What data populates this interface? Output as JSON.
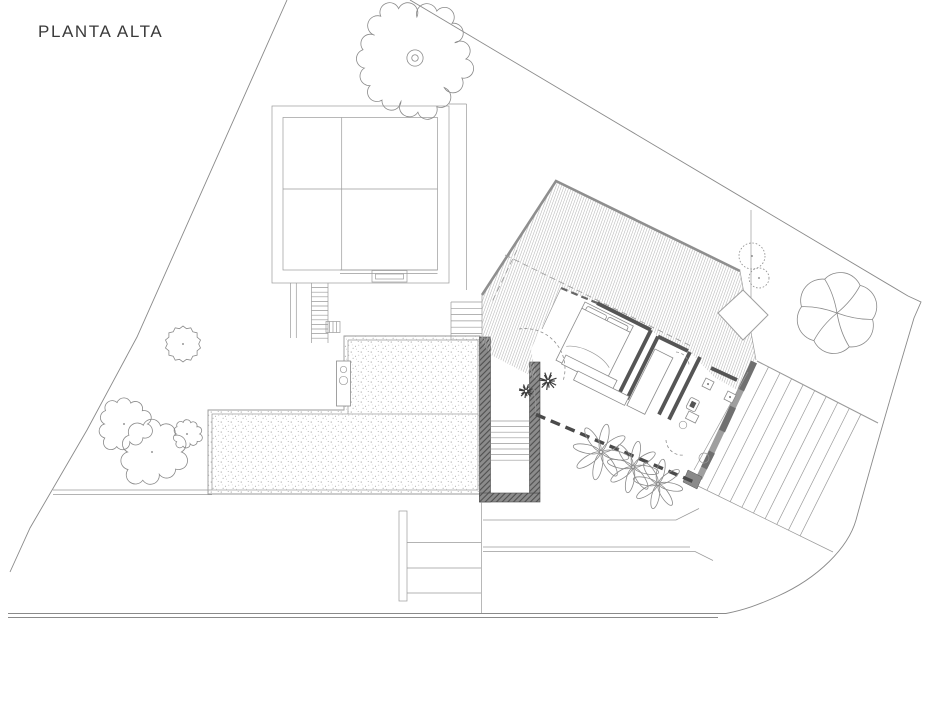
{
  "title": "PLANTA ALTA",
  "colors": {
    "background": "#ffffff",
    "line": "#9a9a9a",
    "wall": "#555555",
    "wall_fill": "#8f8f8f",
    "boundary": "#8a8a8a",
    "hatch_line": "#b5b5b5",
    "stipple_dot": "#8e8e8e",
    "title_text": "#3a3a3a"
  },
  "vegetation": {
    "scalloped_trees": [
      {
        "cx": 413,
        "cy": 59,
        "r": 54
      }
    ],
    "round_trees": [
      {
        "cx": 152,
        "cy": 452,
        "r": 30
      },
      {
        "cx": 124,
        "cy": 424,
        "r": 24
      },
      {
        "cx": 187,
        "cy": 434,
        "r": 13
      }
    ],
    "spiky_trees": [
      {
        "cx": 183,
        "cy": 344,
        "r": 18
      }
    ],
    "dotted_bushes": [
      {
        "cx": 752,
        "cy": 256,
        "r": 13
      },
      {
        "cx": 759,
        "cy": 278,
        "r": 10
      }
    ],
    "pinwheel_trees": [
      {
        "cx": 837,
        "cy": 313,
        "r": 36
      }
    ],
    "palm_plants": [
      {
        "cx": 601,
        "cy": 452,
        "r": 27
      },
      {
        "cx": 633,
        "cy": 467,
        "r": 25
      },
      {
        "cx": 658,
        "cy": 484,
        "r": 24
      }
    ],
    "dark_shrubs": [
      {
        "cx": 548,
        "cy": 381,
        "r": 9
      },
      {
        "cx": 526,
        "cy": 391,
        "r": 7
      }
    ]
  }
}
